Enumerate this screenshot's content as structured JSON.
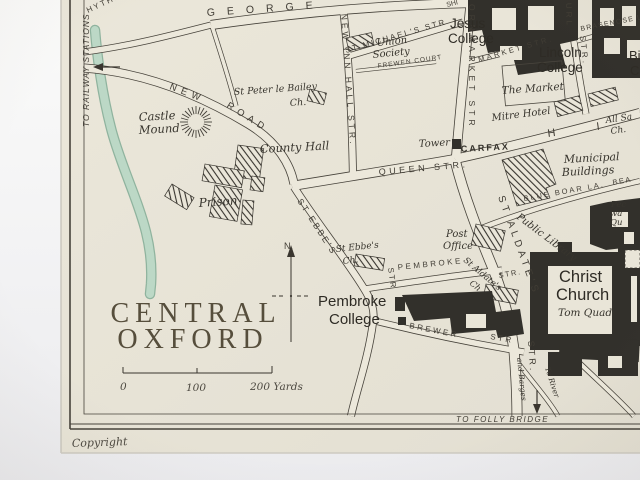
{
  "map": {
    "title": {
      "line1": "CENTRAL",
      "line2": "OXFORD"
    },
    "copyright": "Copyright",
    "compass_label": "N.",
    "scale": {
      "zero": "0",
      "hundred": "100",
      "two_hundred": "200 Yards"
    },
    "edge_labels": {
      "railway": "TO RAILWAY STATIONS",
      "folly": "TO FOLLY BRIDGE",
      "to_river": "To River",
      "barges": "and Barges"
    },
    "streets": {
      "george": "GEORGE",
      "hythe": "HYTHE",
      "new_road_new": "NEW",
      "new_road_road": "ROAD",
      "new_inn_hall": "NEW INN HALL STR.",
      "st_michaels": "ST MICHAEL'S STR",
      "frewen": "FREWEN COURT",
      "cornmarket": "ORNMARKET STR",
      "ship": "SHI",
      "market": "MARKET STR.",
      "turl_url": "URL",
      "turl_str": "STR.",
      "brasenose": "BRASENOSE L",
      "queen": "QUEEN STR.",
      "high_h": "H",
      "high_i": "I",
      "carfax": "CARFAX",
      "st_aldates": "ST ALDATE'S",
      "st_aldates_str": "STR.",
      "blue_boar": "BLUE BOAR LA.",
      "bear": "BEA",
      "pembroke": "PEMBROKE",
      "pembroke_str": "STR.",
      "brewer": "BREWER",
      "brewer_str": "STR",
      "st_ebbes": "ST EBBE'S",
      "st_ebbes_str": "STR"
    },
    "places": {
      "castle_1": "Castle",
      "castle_2": "Mound",
      "prison": "Prison",
      "county_hall": "County Hall",
      "st_peter": "St Peter le Bailey",
      "st_peter_ch": "Ch.",
      "union_1": "Union",
      "union_2": "Society",
      "jesus_1": "Jesus",
      "jesus_2": "College",
      "lincoln_1": "Lincoln",
      "lincoln_2": "College",
      "the_market": "The Market",
      "mitre": "Mitre Hotel",
      "all_saints_1": "All Sa",
      "all_saints_2": "Ch.",
      "tower": "Tower",
      "municipal_1": "Municipal",
      "municipal_2": "Buildings",
      "post_1": "Post",
      "post_2": "Office",
      "library": "Public Library",
      "st_aldates_ch_1": "St Aldate's",
      "st_aldates_ch_2": "Ch.",
      "st_ebbes_ch_1": "St Ebbe's",
      "st_ebbes_ch_2": "Ch.",
      "christ_1": "Christ",
      "christ_2": "Church",
      "tom_quad": "Tom Quad",
      "pembroke_1": "Pembroke",
      "pembroke_2": "College",
      "peck_1": "Pec",
      "peck_2": "wa",
      "peck_3": "Qu",
      "clipped_1": "Bi",
      "clipped_2": "C"
    },
    "colors": {
      "paper": "#e8e4d7",
      "ink": "#3a362f",
      "dark_buildings": "#32302b",
      "stream_fill": "#bcd8c6",
      "stream_edge": "#8fb39e",
      "mat": "#f7f7f6",
      "title_ink": "#564e3c"
    }
  }
}
